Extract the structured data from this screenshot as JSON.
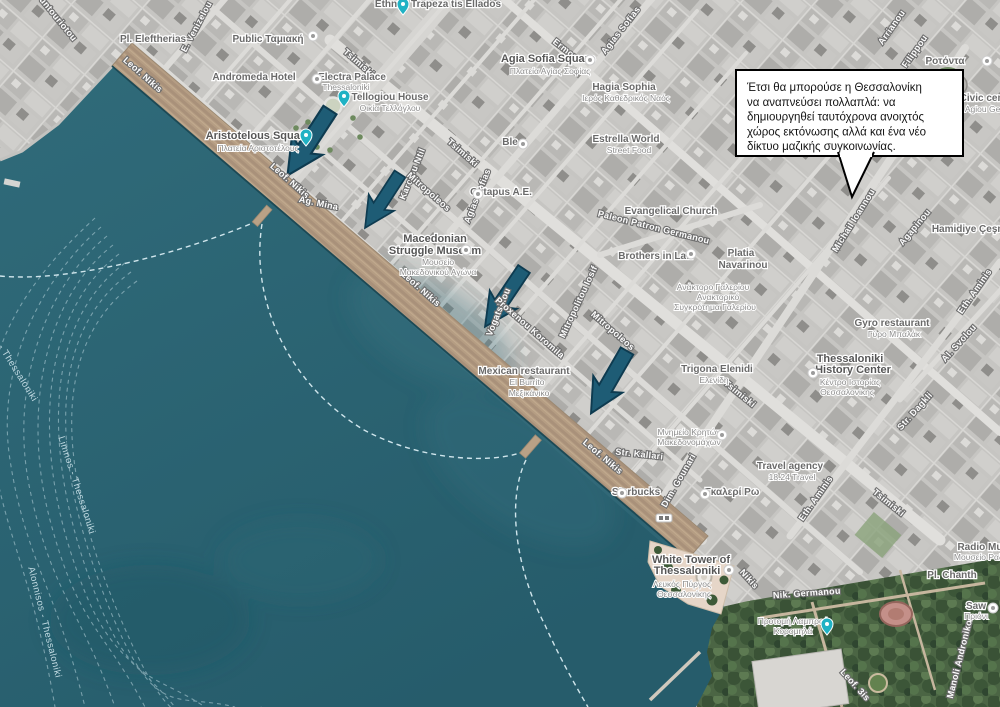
{
  "bubble": {
    "lines": [
      "Έτσι θα μπορούσε η Θεσσαλονίκη",
      "να αναπνεύσει πολλαπλά: να",
      "δημιουργηθεί ταυτόχρονα ανοιχτός",
      "χώρος εκτόνωσης αλλά και ένα νέο",
      "δίκτυο μαζικής συγκοινωνίας."
    ]
  },
  "colors": {
    "sea": "#2b6272",
    "promenade": "#b59d83",
    "arrow": "#1e5c75",
    "pin_teal": "#20b2c4",
    "route_dash": "#d8ecf2"
  },
  "labels": [
    {
      "t": "Kountouriotou",
      "x": 52,
      "y": 16,
      "r": 51,
      "k": "street"
    },
    {
      "t": "E. Venizelou",
      "x": 199,
      "y": 28,
      "r": -62,
      "k": "street"
    },
    {
      "t": "Leof. Nikis",
      "x": 141,
      "y": 77,
      "r": 41,
      "k": "street"
    },
    {
      "t": "Leof. Nikis",
      "x": 288,
      "y": 183,
      "r": 41,
      "k": "street"
    },
    {
      "t": "Leof. Nikis",
      "x": 419,
      "y": 291,
      "r": 41,
      "k": "street"
    },
    {
      "t": "Leof. Nikis",
      "x": 601,
      "y": 459,
      "r": 40,
      "k": "street"
    },
    {
      "t": "Nikis",
      "x": 747,
      "y": 581,
      "r": 48,
      "k": "street"
    },
    {
      "t": "Tsimiski",
      "x": 357,
      "y": 65,
      "r": 41,
      "k": "street"
    },
    {
      "t": "Tsimiski",
      "x": 461,
      "y": 155,
      "r": 41,
      "k": "street"
    },
    {
      "t": "Tsimiski",
      "x": 738,
      "y": 396,
      "r": 39,
      "k": "street"
    },
    {
      "t": "Tsimiski",
      "x": 887,
      "y": 505,
      "r": 39,
      "k": "street"
    },
    {
      "t": "Ermou",
      "x": 564,
      "y": 52,
      "r": 38,
      "k": "street"
    },
    {
      "t": "Agias Sofias",
      "x": 623,
      "y": 32,
      "r": -52,
      "k": "street"
    },
    {
      "t": "Agias Sofias",
      "x": 480,
      "y": 197,
      "r": -68,
      "k": "street"
    },
    {
      "t": "Karolou Ntil",
      "x": 415,
      "y": 175,
      "r": -68,
      "k": "street"
    },
    {
      "t": "Mitropoleos",
      "x": 427,
      "y": 194,
      "r": 41,
      "k": "street"
    },
    {
      "t": "Mitropoleos",
      "x": 611,
      "y": 333,
      "r": 41,
      "k": "street"
    },
    {
      "t": "Vogatsikou",
      "x": 501,
      "y": 313,
      "r": -68,
      "k": "street"
    },
    {
      "t": "Proxenou Koromila",
      "x": 528,
      "y": 330,
      "r": 41,
      "k": "street"
    },
    {
      "t": "Mitropolitou Iosif",
      "x": 581,
      "y": 303,
      "r": -65,
      "k": "street"
    },
    {
      "t": "Paleon Patron Germanou",
      "x": 653,
      "y": 230,
      "r": 14,
      "k": "street"
    },
    {
      "t": "Dim. Gounari",
      "x": 681,
      "y": 482,
      "r": -60,
      "k": "street"
    },
    {
      "t": "Str. Kallari",
      "x": 639,
      "y": 457,
      "r": 6,
      "k": "street"
    },
    {
      "t": "Eth. Aminis",
      "x": 818,
      "y": 500,
      "r": -55,
      "k": "street"
    },
    {
      "t": "Eth. Aminis",
      "x": 977,
      "y": 293,
      "r": -55,
      "k": "street"
    },
    {
      "t": "Al. Svolou",
      "x": 961,
      "y": 345,
      "r": -48,
      "k": "street"
    },
    {
      "t": "Str. Dagkli",
      "x": 917,
      "y": 413,
      "r": -48,
      "k": "street"
    },
    {
      "t": "Agapinou",
      "x": 917,
      "y": 229,
      "r": -50,
      "k": "street"
    },
    {
      "t": "Arrianou",
      "x": 894,
      "y": 29,
      "r": -55,
      "k": "street"
    },
    {
      "t": "Filippou",
      "x": 917,
      "y": 53,
      "r": -55,
      "k": "street"
    },
    {
      "t": "Nik. Germanou",
      "x": 807,
      "y": 596,
      "r": -4,
      "k": "street"
    },
    {
      "t": "Manoli Andronikou",
      "x": 963,
      "y": 657,
      "r": -76,
      "k": "street"
    },
    {
      "t": "Leof. 3is",
      "x": 853,
      "y": 687,
      "r": 48,
      "k": "street"
    },
    {
      "t": "Ag. Mina",
      "x": 318,
      "y": 206,
      "r": 12,
      "k": "street"
    },
    {
      "t": "Michail Ioannou",
      "x": 856,
      "y": 222,
      "r": -58,
      "k": "street"
    },
    {
      "t": "Pl. Eleftherias",
      "x": 153,
      "y": 42,
      "r": 0,
      "k": "poi"
    },
    {
      "t": "Public Ταμιακή",
      "x": 268,
      "y": 42,
      "r": 0,
      "k": "poi"
    },
    {
      "t": "Andromeda Hotel",
      "x": 254,
      "y": 80,
      "r": 0,
      "k": "poi"
    },
    {
      "t": "Electra Palace",
      "x": 352,
      "y": 80,
      "r": 0,
      "k": "poi"
    },
    {
      "t": "Thessaloniki",
      "x": 346,
      "y": 90,
      "r": 0,
      "k": "sub"
    },
    {
      "t": "Tellogiou House",
      "x": 390,
      "y": 100,
      "r": 0,
      "k": "poi"
    },
    {
      "t": "Οικία Τελλόγλου",
      "x": 390,
      "y": 111,
      "r": 0,
      "k": "sub"
    },
    {
      "t": "Ethniki Trapeza tis Ellados",
      "x": 438,
      "y": 7,
      "r": 0,
      "k": "poi"
    },
    {
      "t": "Ble",
      "x": 510,
      "y": 145,
      "r": 0,
      "k": "poi"
    },
    {
      "t": "Estrella World",
      "x": 626,
      "y": 142,
      "r": 0,
      "k": "poi"
    },
    {
      "t": "Street Food",
      "x": 629,
      "y": 153,
      "r": 0,
      "k": "sub"
    },
    {
      "t": "Hagia Sophia",
      "x": 624,
      "y": 90,
      "r": 0,
      "k": "poi"
    },
    {
      "t": "Ιερός Καθεδρικός Ναός",
      "x": 626,
      "y": 101,
      "r": 0,
      "k": "sub"
    },
    {
      "t": "Evangelical Church",
      "x": 671,
      "y": 214,
      "r": 0,
      "k": "poi"
    },
    {
      "t": "Brothers in Law",
      "x": 656,
      "y": 259,
      "r": 0,
      "k": "poi"
    },
    {
      "t": "Platia",
      "x": 741,
      "y": 256,
      "r": 0,
      "k": "poi"
    },
    {
      "t": "Navarinou",
      "x": 743,
      "y": 268,
      "r": 0,
      "k": "poi"
    },
    {
      "t": "Ανάκτορο Γαλερίου",
      "x": 713,
      "y": 290,
      "r": 0,
      "k": "sub"
    },
    {
      "t": "Ανακτορικό",
      "x": 718,
      "y": 300,
      "r": 0,
      "k": "sub"
    },
    {
      "t": "Συγκρότημα Γαλερίου",
      "x": 715,
      "y": 310,
      "r": 0,
      "k": "sub"
    },
    {
      "t": "Oktapus A.E.",
      "x": 501,
      "y": 195,
      "r": 0,
      "k": "poi"
    },
    {
      "t": "Gyro restaurant",
      "x": 892,
      "y": 326,
      "r": 0,
      "k": "poi"
    },
    {
      "t": "Γύρο Μπαλάκ",
      "x": 894,
      "y": 337,
      "r": 0,
      "k": "sub"
    },
    {
      "t": "Travel agency",
      "x": 790,
      "y": 469,
      "r": 0,
      "k": "poi"
    },
    {
      "t": "18.24 Travel",
      "x": 792,
      "y": 480,
      "r": 0,
      "k": "sub"
    },
    {
      "t": "Γκαλερί Ρω",
      "x": 732,
      "y": 495,
      "r": 0,
      "k": "poi"
    },
    {
      "t": "Starbucks",
      "x": 636,
      "y": 495,
      "r": 0,
      "k": "poi"
    },
    {
      "t": "Trigona Elenidi",
      "x": 717,
      "y": 372,
      "r": 0,
      "k": "poi"
    },
    {
      "t": "Ελενίδη",
      "x": 714,
      "y": 383,
      "r": 0,
      "k": "sub"
    },
    {
      "t": "Μνημείο Κρητών",
      "x": 689,
      "y": 435,
      "r": 0,
      "k": "sub"
    },
    {
      "t": "Μακεδονομάχων",
      "x": 689,
      "y": 445,
      "r": 0,
      "k": "sub"
    },
    {
      "t": "Προτομή Λαμπρού",
      "x": 793,
      "y": 624,
      "r": 0,
      "k": "sub"
    },
    {
      "t": "Κορομηλά",
      "x": 793,
      "y": 634,
      "r": 0,
      "k": "sub"
    },
    {
      "t": "Saw",
      "x": 976,
      "y": 609,
      "r": 0,
      "k": "poi"
    },
    {
      "t": "Πριόνι",
      "x": 976,
      "y": 619,
      "r": 0,
      "k": "sub"
    },
    {
      "t": "Radio Museum",
      "x": 993,
      "y": 550,
      "r": 0,
      "k": "poi"
    },
    {
      "t": "Μουσείο Ραδιοφώνου",
      "x": 995,
      "y": 560,
      "r": 0,
      "k": "sub"
    },
    {
      "t": "Hamidiye Çeşmesi",
      "x": 976,
      "y": 232,
      "r": 0,
      "k": "poi"
    },
    {
      "t": "Pl. Chanth",
      "x": 952,
      "y": 578,
      "r": 0,
      "k": "poi"
    },
    {
      "t": "Civic center",
      "x": 988,
      "y": 101,
      "r": 0,
      "k": "poi"
    },
    {
      "t": "P. Agiou Georgiou",
      "x": 990,
      "y": 112,
      "r": 0,
      "k": "sub"
    },
    {
      "t": "Ροτόντα",
      "x": 945,
      "y": 64,
      "r": 0,
      "k": "poi"
    },
    {
      "t": "Mexican restaurant",
      "x": 524,
      "y": 374,
      "r": 0,
      "k": "poi"
    },
    {
      "t": "El Burrito",
      "x": 527,
      "y": 385,
      "r": 0,
      "k": "sub"
    },
    {
      "t": "Μεξικάνικο",
      "x": 529,
      "y": 396,
      "r": 0,
      "k": "sub"
    },
    {
      "t": "Aristotelous Square",
      "x": 258,
      "y": 139,
      "r": 0,
      "k": "title"
    },
    {
      "t": "Πλατεία Αριστοτέλους",
      "x": 258,
      "y": 151,
      "r": 0,
      "k": "sub"
    },
    {
      "t": "Agia Sofia Square",
      "x": 548,
      "y": 62,
      "r": 0,
      "k": "title"
    },
    {
      "t": "Πλατεία Αγίας Σοφίας",
      "x": 550,
      "y": 74,
      "r": 0,
      "k": "sub"
    },
    {
      "t": "Macedonian",
      "x": 435,
      "y": 242,
      "r": 0,
      "k": "title"
    },
    {
      "t": "Struggle Museum",
      "x": 435,
      "y": 254,
      "r": 0,
      "k": "title"
    },
    {
      "t": "Μουσείο",
      "x": 438,
      "y": 265,
      "r": 0,
      "k": "sub"
    },
    {
      "t": "Μακεδονικού Αγώνα",
      "x": 438,
      "y": 275,
      "r": 0,
      "k": "sub"
    },
    {
      "t": "White Tower of",
      "x": 691,
      "y": 563,
      "r": 0,
      "k": "title"
    },
    {
      "t": "Thessaloniki",
      "x": 687,
      "y": 574,
      "r": 0,
      "k": "title"
    },
    {
      "t": "Λευκός Πύργος",
      "x": 682,
      "y": 587,
      "r": 0,
      "k": "sub"
    },
    {
      "t": "Θεσσαλονίκης",
      "x": 684,
      "y": 597,
      "r": 0,
      "k": "sub"
    },
    {
      "t": "Thessaloniki",
      "x": 850,
      "y": 362,
      "r": 0,
      "k": "title"
    },
    {
      "t": "History Center",
      "x": 853,
      "y": 373,
      "r": 0,
      "k": "title"
    },
    {
      "t": "Κέντρο Ιστορίας",
      "x": 850,
      "y": 385,
      "r": 0,
      "k": "sub"
    },
    {
      "t": "Θεσσαλονίκης",
      "x": 847,
      "y": 395,
      "r": 0,
      "k": "sub"
    },
    {
      "t": "Skiathos - Thessaloniki",
      "x": 4,
      "y": 356,
      "r": 58,
      "k": "route"
    },
    {
      "t": "Limnos - Thessaloniki",
      "x": 74,
      "y": 486,
      "r": 72,
      "k": "route"
    },
    {
      "t": "Alonnisos - Thessaloniki",
      "x": 42,
      "y": 623,
      "r": 76,
      "k": "route"
    }
  ],
  "pins": [
    {
      "x": 306,
      "y": 139,
      "type": "map-pin"
    },
    {
      "x": 344,
      "y": 100,
      "type": "map-pin"
    },
    {
      "x": 403,
      "y": 8,
      "type": "map-pin"
    },
    {
      "x": 827,
      "y": 628,
      "type": "map-pin"
    },
    {
      "x": 313,
      "y": 36,
      "type": "poi-dot"
    },
    {
      "x": 317,
      "y": 79,
      "type": "poi-dot"
    },
    {
      "x": 466,
      "y": 250,
      "type": "poi-dot"
    },
    {
      "x": 590,
      "y": 60,
      "type": "poi-dot"
    },
    {
      "x": 523,
      "y": 144,
      "type": "poi-dot"
    },
    {
      "x": 691,
      "y": 254,
      "type": "poi-dot"
    },
    {
      "x": 722,
      "y": 435,
      "type": "poi-dot"
    },
    {
      "x": 813,
      "y": 373,
      "type": "poi-dot"
    },
    {
      "x": 729,
      "y": 570,
      "type": "poi-dot"
    },
    {
      "x": 987,
      "y": 61,
      "type": "poi-dot"
    },
    {
      "x": 993,
      "y": 608,
      "type": "poi-dot"
    },
    {
      "x": 622,
      "y": 493,
      "type": "poi-dot"
    },
    {
      "x": 705,
      "y": 494,
      "type": "poi-dot"
    },
    {
      "x": 478,
      "y": 194,
      "type": "poi-dot"
    },
    {
      "x": 664,
      "y": 518,
      "type": "transit-stop"
    }
  ],
  "arrows": [
    {
      "x": 330,
      "y": 110,
      "r": 33,
      "s": 1.3
    },
    {
      "x": 400,
      "y": 174,
      "r": 33,
      "s": 1.07
    },
    {
      "x": 524,
      "y": 269,
      "r": 34,
      "s": 1.16
    },
    {
      "x": 627,
      "y": 351,
      "r": 30,
      "s": 1.2
    }
  ]
}
